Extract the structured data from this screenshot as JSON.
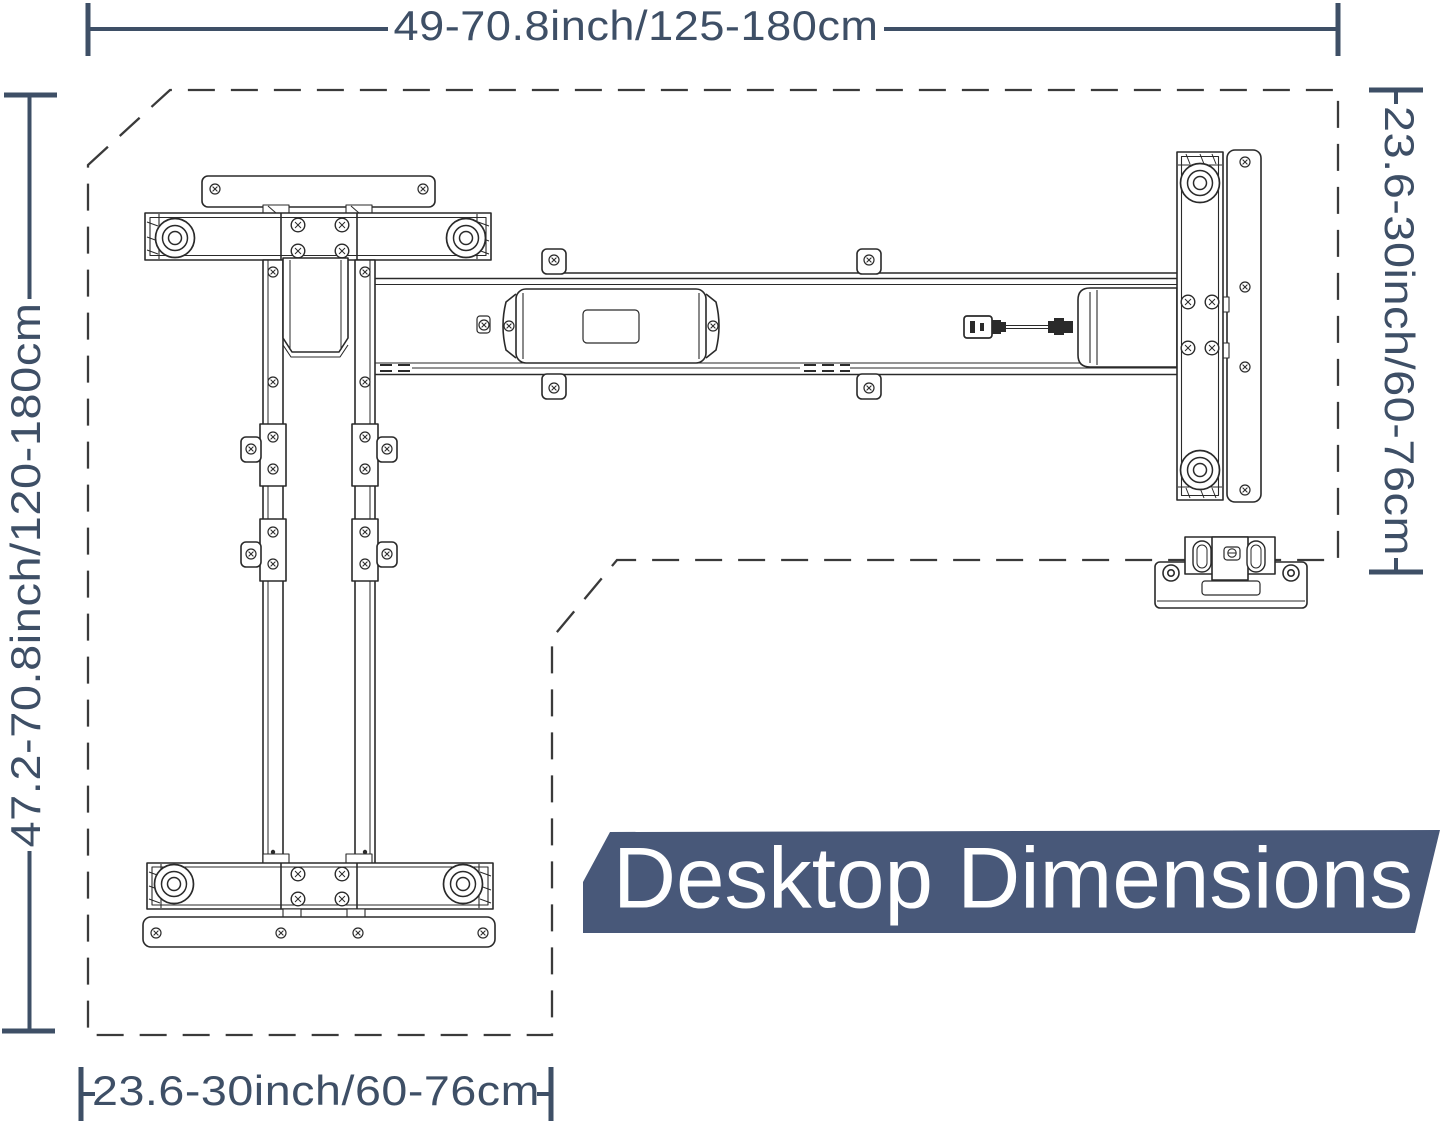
{
  "page": {
    "background_color": "#ffffff"
  },
  "banner": {
    "label": "Desktop Dimensions",
    "bg_color": "#485879",
    "text_color": "#ffffff"
  },
  "dimensions": {
    "color": "#3e4f66",
    "top_label": "49-70.8inch/125-180cm",
    "left_label": "47.2-70.8inch/120-180cm",
    "right_label": "23.6-30inch/60-76cm",
    "bottom_label": "23.6-30inch/60-76cm"
  },
  "drawing": {
    "line_color": "#2a2a2a",
    "outline_color": "#3a3a3a"
  }
}
